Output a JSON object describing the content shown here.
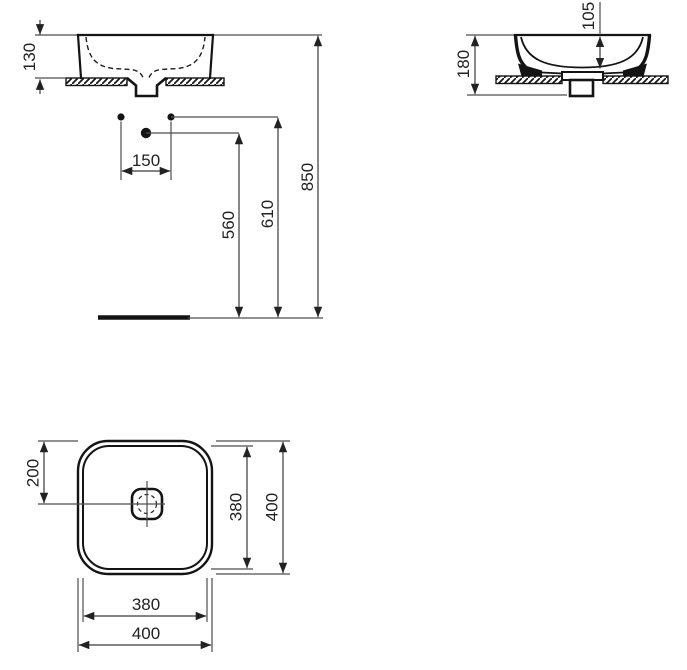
{
  "drawing_title": "washbasin-technical-dimension-drawing",
  "colors": {
    "background": "#ffffff",
    "object_line": "#141414",
    "dimension_line": "#4a4a4a",
    "text": "#222222"
  },
  "dimensions": {
    "front": {
      "basin_height_above_counter": "130",
      "hole_spacing": "150",
      "rim_height_from_floor": "850",
      "upper_fixing_height": "610",
      "lower_fixing_height": "560"
    },
    "side": {
      "overall_height": "180",
      "inner_bowl_depth": "105"
    },
    "plan": {
      "drain_center_offset": "200",
      "inner_depth": "380",
      "outer_depth": "400",
      "inner_width": "380",
      "outer_width": "400"
    }
  }
}
